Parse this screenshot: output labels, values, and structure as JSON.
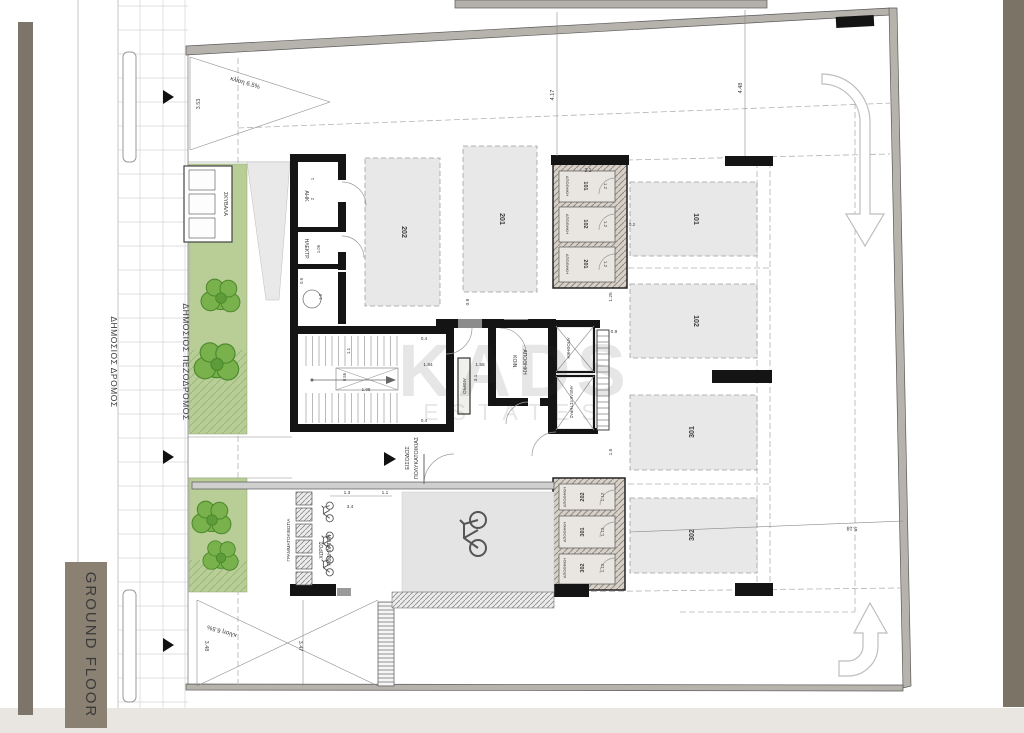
{
  "plan": {
    "title": "GROUND FLOOR",
    "watermark": {
      "brand": "KADS",
      "sub": "ESTATES"
    },
    "streets": {
      "road": "ΔΗΜΟΣΙΟΣ ΔΡΟΜΟΣ",
      "sidewalk": "ΔΗΜΟΣΙΟΣ ΠΕΖΟΔΡΟΜΟΣ"
    },
    "labels": {
      "garbage": "ΣΚΥΒΑΛΑ",
      "ahk": "ΑΗΚ",
      "electrical": "ΗΛΕΚΤΡ.",
      "common_storage_1": "ΚΟΙΝ.",
      "common_storage_2": "ΑΠΟΘΗΚΗ",
      "storage_x": "ΑΠΟΘΗΚΗ",
      "elevator": "ΑΝΕΛΚΥΣΤΗΡΑΣ",
      "atrium": "ΑΙΘΡΙΟ",
      "entrance_1": "ΕΙΣΟΔΟΣ",
      "entrance_2": "ΠΟΛΥΚΑΤΟΙΚΙΑΣ",
      "mailboxes": "ΓΡΑΜΜΑΤΟΚΙΒΩΤΙΑ",
      "bicycles_1": "ΧΩΡΟΣ",
      "bicycles_2": "ΠΟΔΗΛΑΤΩΝ",
      "slope_top": "κλίση 6.5%",
      "slope_bottom": "κλίση 6.5%"
    },
    "parking_spaces": [
      {
        "id": "202"
      },
      {
        "id": "201"
      },
      {
        "id": "101"
      },
      {
        "id": "102"
      },
      {
        "id": "301"
      },
      {
        "id": "302"
      }
    ],
    "storage_top": [
      {
        "name": "ΑΠΟΘΗΚΗ",
        "unit": "101",
        "width": "1.2"
      },
      {
        "name": "ΑΠΟΘΗΚΗ",
        "unit": "102",
        "width": "1.2"
      },
      {
        "name": "ΑΠΟΘΗΚΗ",
        "unit": "201",
        "width": "1.2"
      }
    ],
    "storage_bottom": [
      {
        "name": "ΑΠΟΘΗΚΗ",
        "unit": "202",
        "width": "1.12"
      },
      {
        "name": "ΑΠΟΘΗΚΗ",
        "unit": "301",
        "width": "1.12"
      },
      {
        "name": "ΑΠΟΘΗΚΗ",
        "unit": "302",
        "width": "1.12"
      }
    ],
    "dimensions": {
      "d353": "3.53",
      "d417": "4.17",
      "d448": "4.48",
      "d518": "5.18",
      "d348": "3.48",
      "d347": "3.47",
      "d21": "2.1",
      "d02": "0.2",
      "d125": "1.25",
      "d09_top": "0.9",
      "d15": "1.5",
      "d1": "1",
      "d2": "2",
      "d106": "1.06",
      "d09_left": "0.9",
      "d18": "1.8",
      "d04_a": "0.4",
      "d04_b": "0.4",
      "d11": "1.1",
      "d056": "0.56",
      "d198": "1.98",
      "d184": "1.84",
      "d155": "1.55",
      "d31": "3.1",
      "d09_mid": "0.9",
      "d13": "1.3",
      "d11_b": "1.1",
      "d34": "3.4"
    },
    "colors": {
      "accent_olive": "#7d7569",
      "green": "#b9cd97",
      "wall": "#141414"
    }
  }
}
